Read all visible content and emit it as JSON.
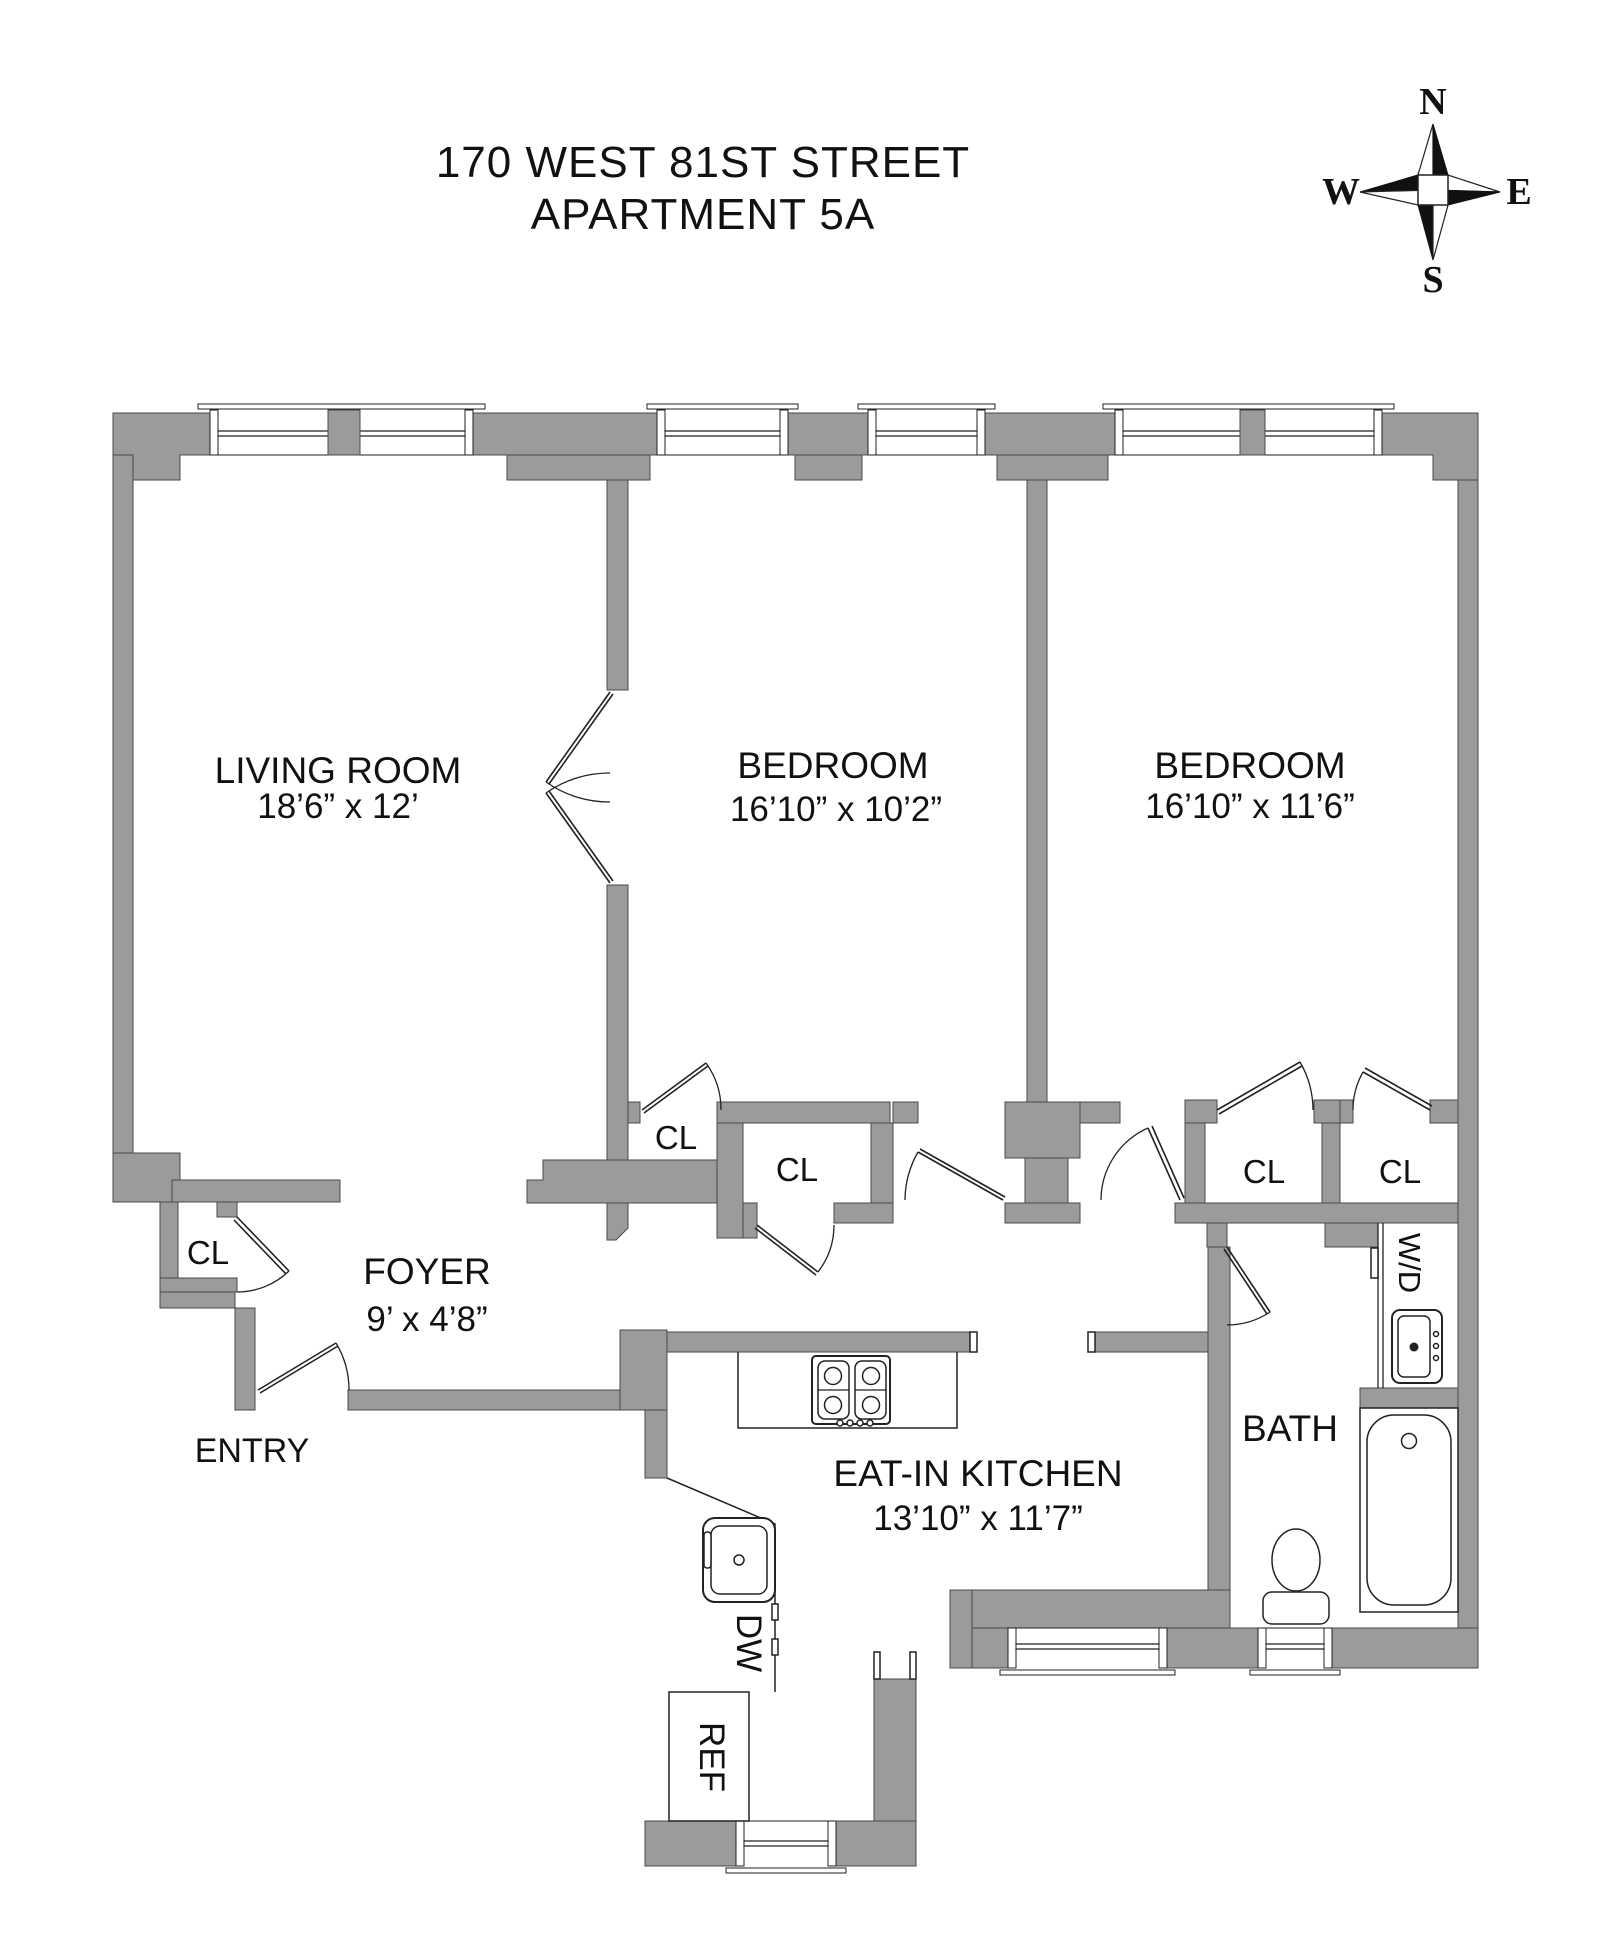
{
  "title": {
    "line1": "170 WEST 81ST STREET",
    "line2": "APARTMENT 5A"
  },
  "compass": {
    "north": "N",
    "south": "S",
    "east": "E",
    "west": "W"
  },
  "rooms": {
    "living_room": {
      "name": "LIVING ROOM",
      "dims": "18’6” x 12’"
    },
    "bedroom_mid": {
      "name": "BEDROOM",
      "dims": "16’10” x 10’2”"
    },
    "bedroom_right": {
      "name": "BEDROOM",
      "dims": "16’10” x 11’6”"
    },
    "foyer": {
      "name": "FOYER",
      "dims": "9’ x 4’8”"
    },
    "kitchen": {
      "name": "EAT-IN KITCHEN",
      "dims": "13’10” x 11’7”"
    },
    "bath": {
      "name": "BATH"
    }
  },
  "labels": {
    "closet": "CL",
    "entry": "ENTRY",
    "washer_dryer": "W/D",
    "dishwasher": "DW",
    "refrigerator": "REF"
  },
  "colors": {
    "wall": "#9b9b9b",
    "wall_edge": "#4a4a4a",
    "line": "#222222",
    "text": "#111111",
    "background": "#ffffff"
  }
}
